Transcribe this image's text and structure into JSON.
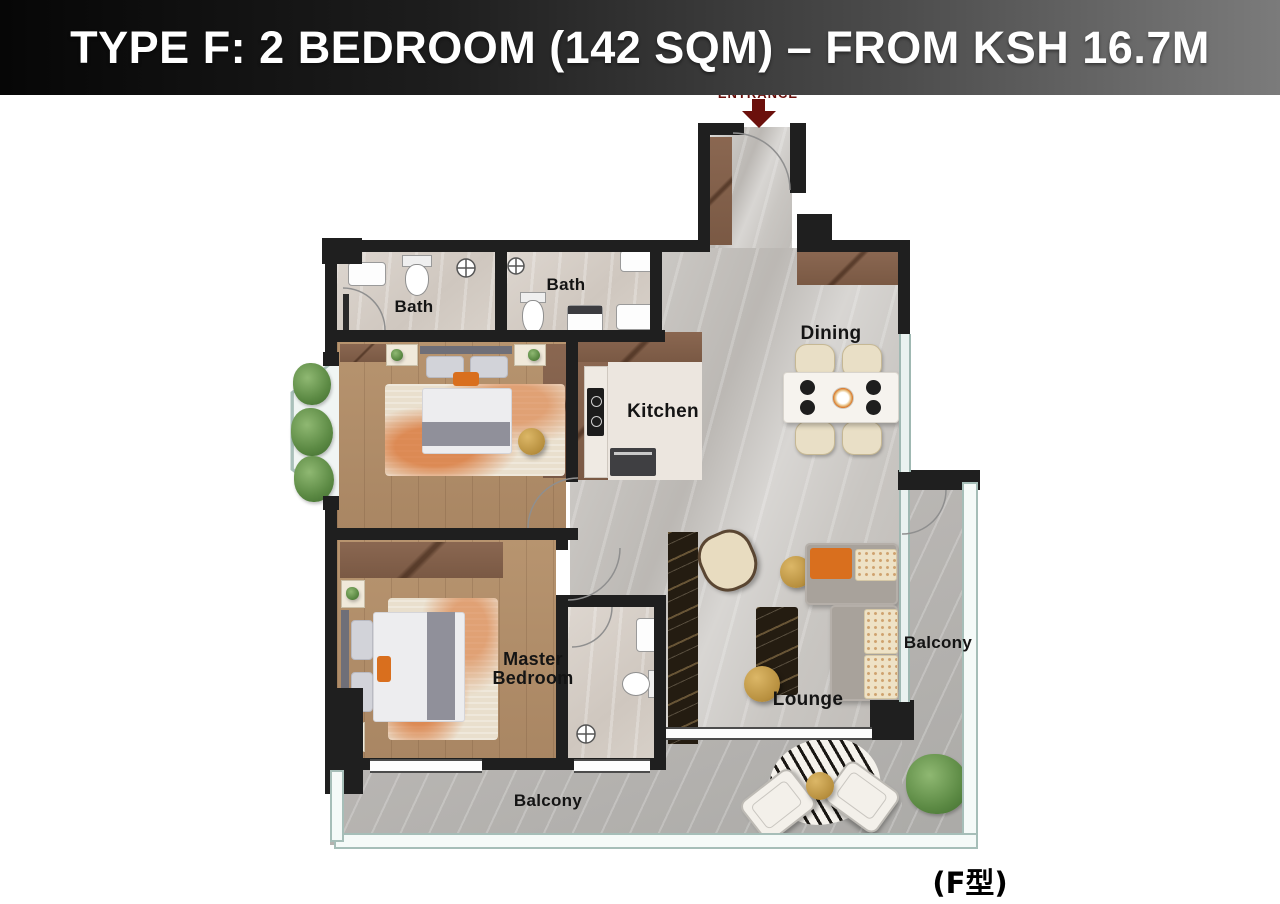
{
  "header": {
    "title": "TYPE F: 2 BEDROOM (142 SQM) – FROM KSH 16.7M"
  },
  "entrance": {
    "label": "ENTRANCE"
  },
  "labels": {
    "bath_left": "Bath",
    "bath_right": "Bath",
    "dining": "Dining",
    "kitchen": "Kitchen",
    "master_bedroom": "Master Bedroom",
    "lounge": "Lounge",
    "balcony_right": "Balcony",
    "balcony_bottom": "Balcony"
  },
  "footer": {
    "unit_type": "(F型)"
  },
  "colors": {
    "banner_gradient_left": "#060606",
    "banner_gradient_right": "#7b7b7b",
    "banner_text": "#ffffff",
    "entrance_red": "#6b100c",
    "wall_black": "#1f1f1f",
    "wood_floor": "#b7946f",
    "marble_floor": "#c9c6c2",
    "bath_floor": "#d5cec7",
    "balcony_floor": "#b3b0ad",
    "cabinet_brown": "#82614c",
    "accent_orange": "#d96f1e",
    "gold": "#c79b4e",
    "glass": "#eaf2f0",
    "label_text": "#141414"
  }
}
